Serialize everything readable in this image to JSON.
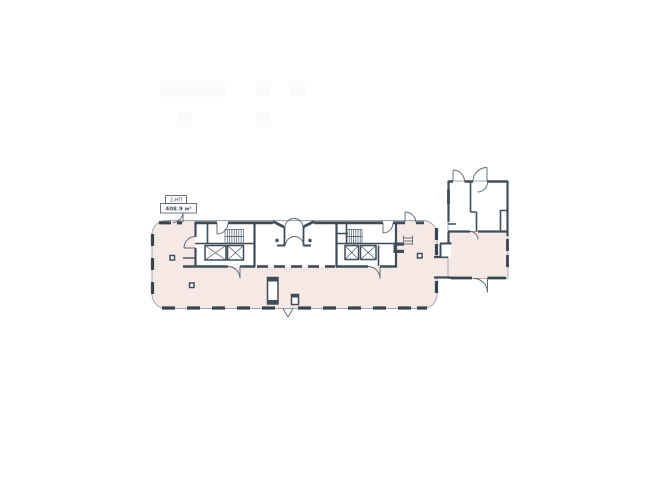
{
  "plan": {
    "unit_label": "2-НП",
    "unit_area": "408.9 м²"
  },
  "colors": {
    "background": "#ffffff",
    "floor_fill": "#f6e8e4",
    "wall": "#3e4d59",
    "glazing": "#36454f",
    "thin_line": "#9aa6b1",
    "door_line": "#55656f",
    "label_text": "#49525c",
    "ghost": "#fafafa"
  }
}
